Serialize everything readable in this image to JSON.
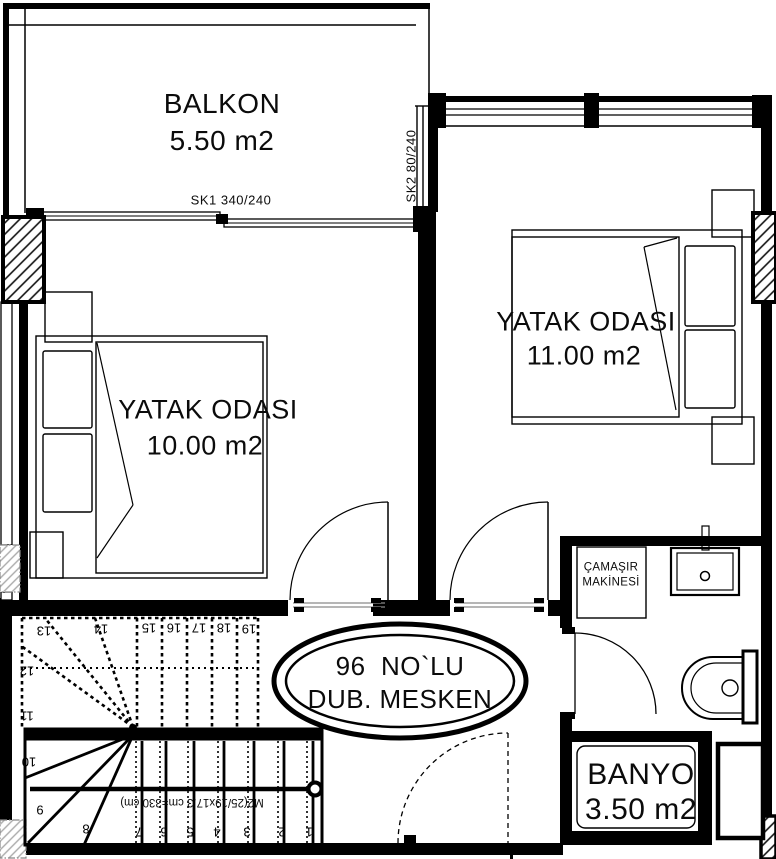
{
  "plan": {
    "balcony": {
      "name": "BALKON",
      "area": "5.50 m2"
    },
    "windows": {
      "sk1": "SK1 340/240",
      "sk2": "SK2 80/240"
    },
    "bedroom_left": {
      "name": "YATAK ODASI",
      "area": "10.00 m2"
    },
    "bedroom_right": {
      "name": "YATAK ODASI",
      "area": "11.00 m2"
    },
    "unit": {
      "line1": "96  NO`LU",
      "line2": "DUB. MESKEN"
    },
    "laundry": {
      "line1": "ÇAMAŞIR",
      "line2": "MAKİNESİ"
    },
    "bathroom": {
      "name": "BANYO",
      "area": "3.50 m2"
    },
    "stairs": {
      "numbers": [
        "1",
        "2",
        "3",
        "4",
        "5",
        "6",
        "7",
        "8",
        "9",
        "10",
        "11",
        "12",
        "13",
        "14",
        "15",
        "16",
        "17",
        "18",
        "19"
      ],
      "formula": "M2(25/19x17.3 cm=330 cm)"
    },
    "colors": {
      "line": "#000000",
      "hatch_gray": "#aaaaaa",
      "threshold_gray": "#8a8a8a"
    }
  }
}
